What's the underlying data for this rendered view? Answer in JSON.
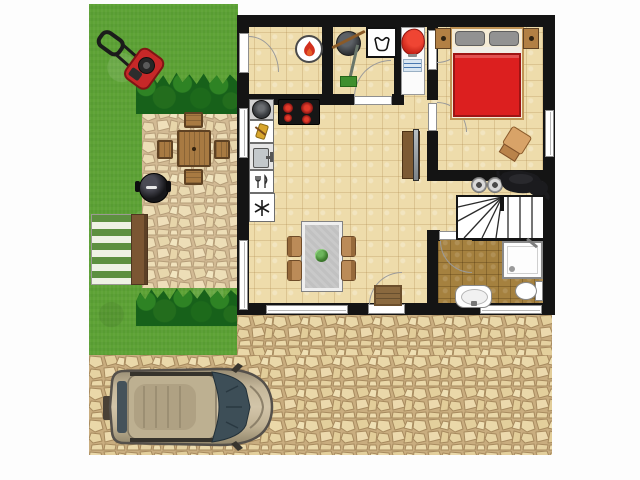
{
  "meta": {
    "title": "Top-down floor plan of a small house with garden, patio and driveway",
    "type": "floor-plan",
    "visible_text": []
  },
  "colors": {
    "wall": "#141414",
    "floor": "#eedcab",
    "floor_line": "#c9a974",
    "bath_floor": "#a5813f",
    "grass": "#5da235",
    "hedge": "#17611a",
    "hedge_light": "#2e8324",
    "stone_mortar": "#c9ad7f",
    "stone_fill": "#ead8a9",
    "window_frame": "#8f8f8f",
    "bed_red": "#dc1f1f",
    "pillow_gray": "#929292",
    "wood": "#a87a42",
    "wood_dark": "#5f4223",
    "chair_tan": "#bb8b58",
    "table_top": "#c9c9c9",
    "lounger_green": "#5d9040",
    "lounger_wood": "#7b5633",
    "grill_black": "#17171a",
    "mower_red": "#c62828",
    "car_body": "#c0b294",
    "car_glass": "#3d4e57",
    "laundry_bowl_red": "#d5291c",
    "burner_red": "#d32020",
    "plant_green": "#3f7d2e",
    "mat_brown": "#8a693f",
    "tv_gray": "#9aa0a4",
    "dog_black": "#1b1b1e"
  },
  "outdoor": {
    "garden": [
      "lawn",
      "lawn-mower",
      "hedge-top",
      "hedge-bottom",
      "patio-paving",
      "patio-table",
      "patio-chairs (4)",
      "bbq-grill",
      "sun-lounger"
    ],
    "driveway": [
      "stone-paving",
      "car (top view, facing right)"
    ]
  },
  "rooms": [
    {
      "name": "boiler-room",
      "items": [
        "boiler-stove with flame symbol",
        "garden-door"
      ]
    },
    {
      "name": "utility-room",
      "items": [
        "cleaning-bucket",
        "broom",
        "mop",
        "washing-machine",
        "door"
      ]
    },
    {
      "name": "laundry-niche",
      "items": [
        "laundry-cabinet",
        "red-wash-bowl",
        "blue-label"
      ]
    },
    {
      "name": "kitchen",
      "items": [
        "cooking-pot",
        "cooktop (4 burners)",
        "utensil-cabinet",
        "kitchen-sink",
        "cutlery-drawer",
        "freezer"
      ]
    },
    {
      "name": "living-dining-room",
      "items": [
        "dining-table",
        "dining-chairs (4)",
        "table-plant",
        "tv-sideboard",
        "doormat",
        "front-door",
        "window-front"
      ]
    },
    {
      "name": "bedroom",
      "items": [
        "double-bed (red blanket, 2 gray pillows)",
        "nightstand-left",
        "nightstand-right",
        "bedroom-chair",
        "window-right"
      ]
    },
    {
      "name": "hallway",
      "items": [
        "dog",
        "dog-bowls (2)",
        "staircase"
      ]
    },
    {
      "name": "bathroom",
      "items": [
        "shower",
        "toilet",
        "washbasin",
        "window-bottom"
      ]
    }
  ]
}
